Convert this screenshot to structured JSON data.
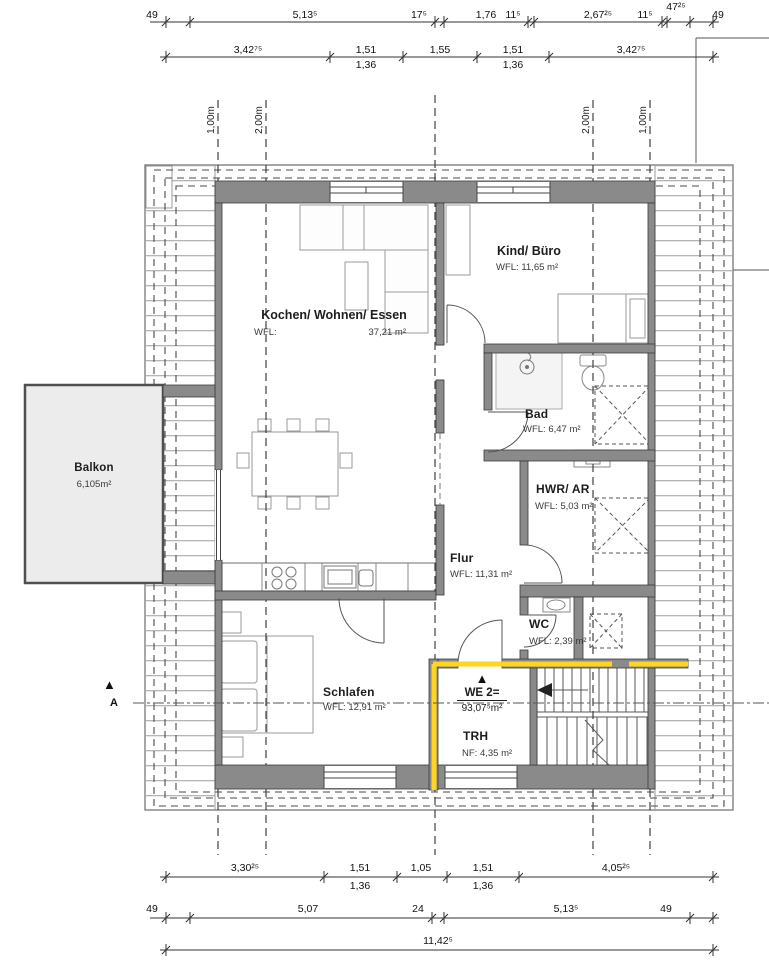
{
  "rooms": {
    "kochen": {
      "name": "Kochen/ Wohnen/ Essen",
      "area_label": "WFL:",
      "area_value": "37,21 m²"
    },
    "kind": {
      "name": "Kind/ Büro",
      "area": "WFL:  11,65 m²"
    },
    "bad": {
      "name": "Bad",
      "area": "WFL: 6,47 m²"
    },
    "hwr": {
      "name": "HWR/ AR",
      "area": "WFL: 5,03 m²"
    },
    "flur": {
      "name": "Flur",
      "area": "WFL: 11,31 m²"
    },
    "wc": {
      "name": "WC",
      "area": "WFL: 2,39 m²"
    },
    "schlafen": {
      "name": "Schlafen",
      "area": "WFL: 12,91 m²"
    },
    "trh": {
      "name": "TRH",
      "area": "NF: 4,35 m²"
    },
    "balkon": {
      "name": "Balkon",
      "area": "6,105m²"
    }
  },
  "unit": {
    "marker": "▲",
    "label": "WE 2=",
    "area": "93,07⁵m²"
  },
  "section_marker": {
    "symbol": "▲",
    "label": "A"
  },
  "heights": [
    "1,00m",
    "2,00m",
    "2,00m",
    "1,00m"
  ],
  "dims": {
    "t1": [
      "49",
      "5,13⁵",
      "17⁵",
      "1,76",
      "11⁵",
      "2,67²⁵",
      "11⁵",
      "47²⁵",
      "49"
    ],
    "t2": [
      "3,42⁷⁵",
      "1,51",
      "1,55",
      "1,51",
      "3,42⁷⁵"
    ],
    "t2_sub": [
      "1,36",
      "1,36"
    ],
    "b1": [
      "3,30²⁵",
      "1,51",
      "1,05",
      "1,51",
      "4,05²⁵"
    ],
    "b1_sub": [
      "1,36",
      "1,36"
    ],
    "b2": [
      "49",
      "5,07",
      "24",
      "5,13⁵",
      "49"
    ],
    "b3": [
      "11,42⁵"
    ]
  },
  "colors": {
    "wall_fill": "#8a8a8a",
    "highlight_yellow": "#ffd51e",
    "balcony_fill": "#ececec",
    "roof_hatch": "#b5b5b5",
    "line_dark": "#3c3c3c"
  }
}
